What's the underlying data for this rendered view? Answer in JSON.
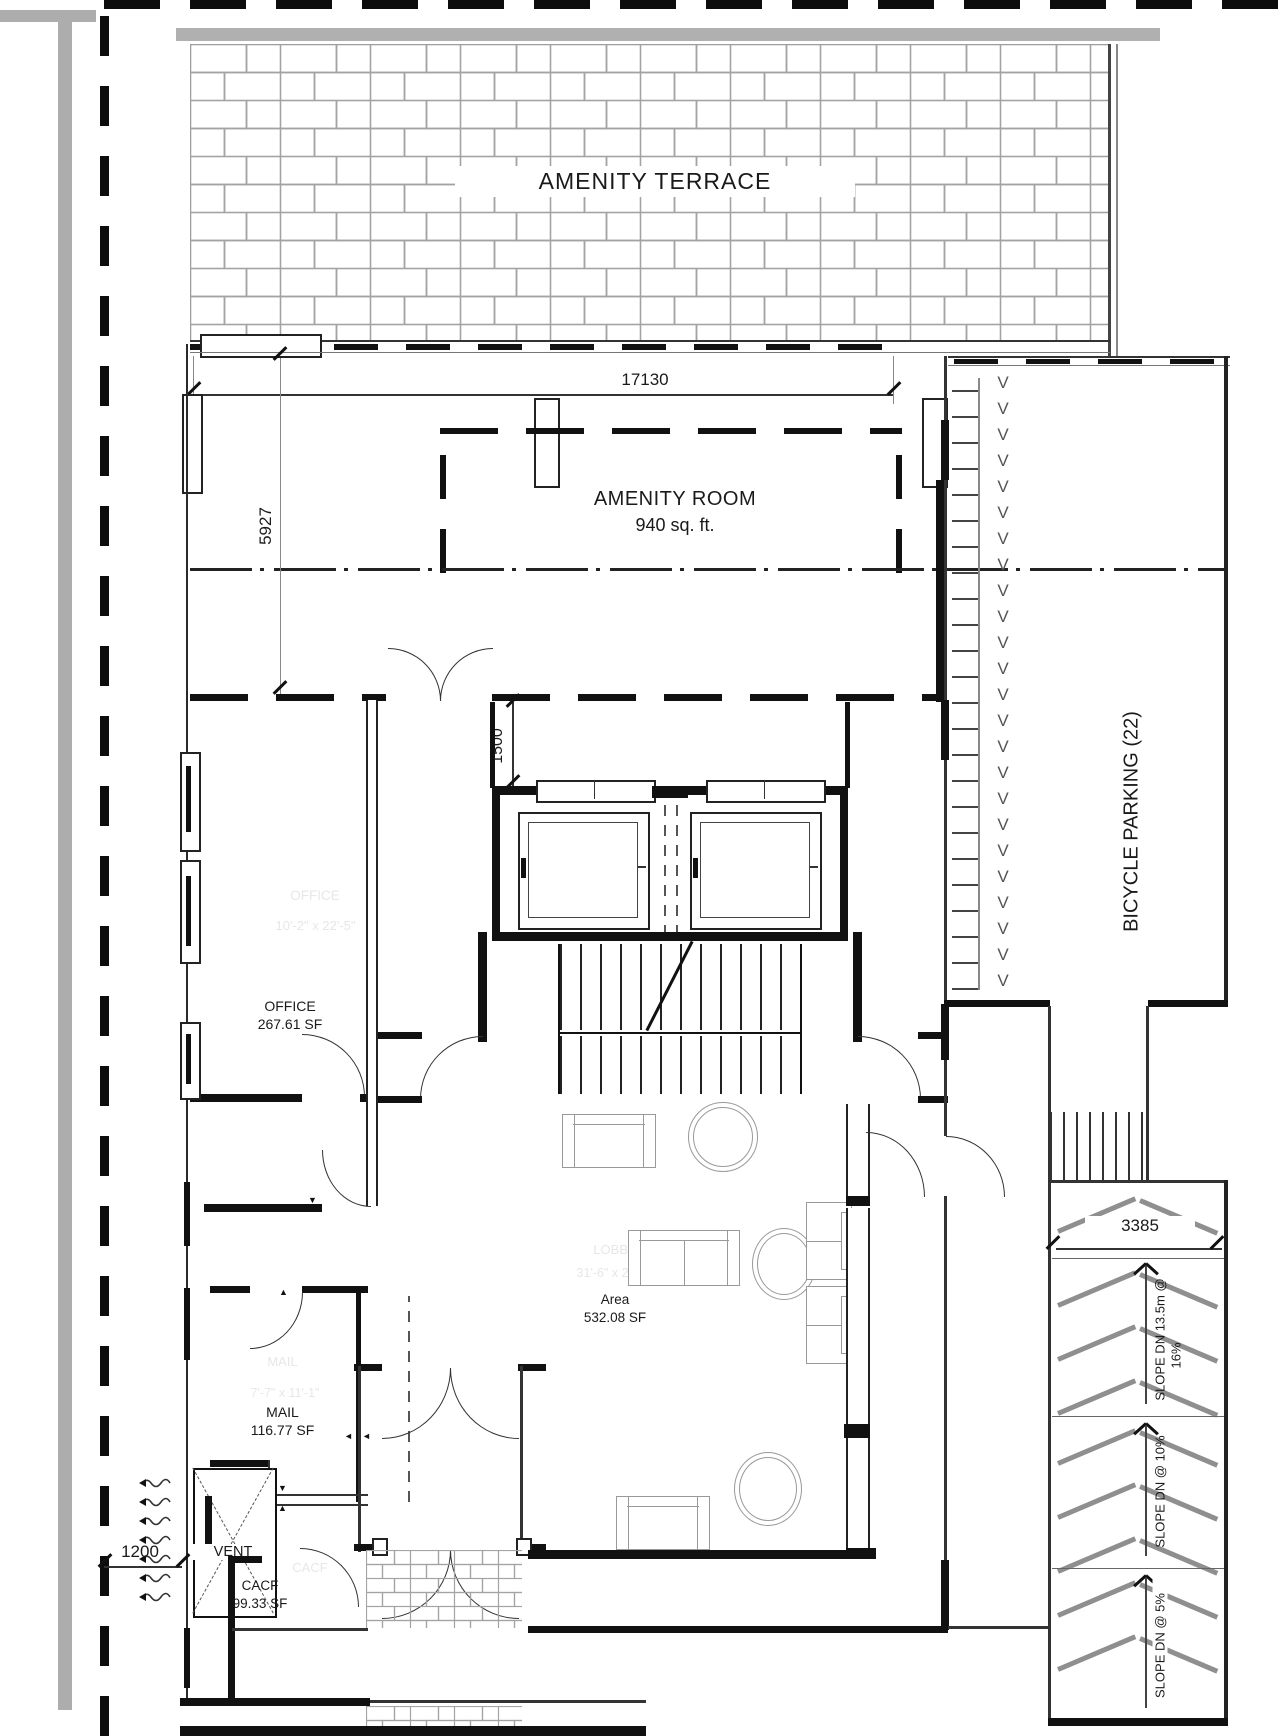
{
  "plan_labels": {
    "terrace": "AMENITY TERRACE",
    "amenity_room_name": "AMENITY ROOM",
    "amenity_room_area": "940 sq. ft.",
    "office_faint_name": "OFFICE",
    "office_faint_dims": "10'-2\" x 22'-5\"",
    "office_name": "OFFICE",
    "office_area": "267.61 SF",
    "mail_faint_name": "MAIL",
    "mail_faint_dims": "7'-7\" x 11'-1\"",
    "mail_name": "MAIL",
    "mail_area": "116.77 SF",
    "vent_name": "VENT",
    "cacf_faint_name": "CACF",
    "cacf_name": "CACF",
    "cacf_area": "99.33 SF",
    "lobby_faint_name": "LOBBY",
    "lobby_faint_dims": "31'-6\" x 29'-4\"",
    "lobby_area_label": "Area",
    "lobby_area_value": "532.08 SF",
    "bicycle_parking": "BICYCLE PARKING (22)"
  },
  "dimensions": {
    "terrace_width": "17130",
    "amenity_depth": "5927",
    "elevator_lobby": "1500",
    "ramp_width": "3385",
    "site_edge": "1200"
  },
  "ramp_annotations": {
    "slope_16_line1": "SLOPE DN 13.5m @",
    "slope_16_line2": "16%",
    "slope_10": "SLOPE DN @ 10%",
    "slope_5": "SLOPE DN @ 5%"
  },
  "symbols": {
    "bike_rack_column": "V\nV\nV\nV\nV\nV\nV\nV\nV\nV\nV\nV\nV\nV\nV\nV\nV\nV\nV\nV\nV\nV\nV\nV",
    "triangle_up": "▲",
    "triangle_down": "▼",
    "triangle_left": "◄"
  }
}
